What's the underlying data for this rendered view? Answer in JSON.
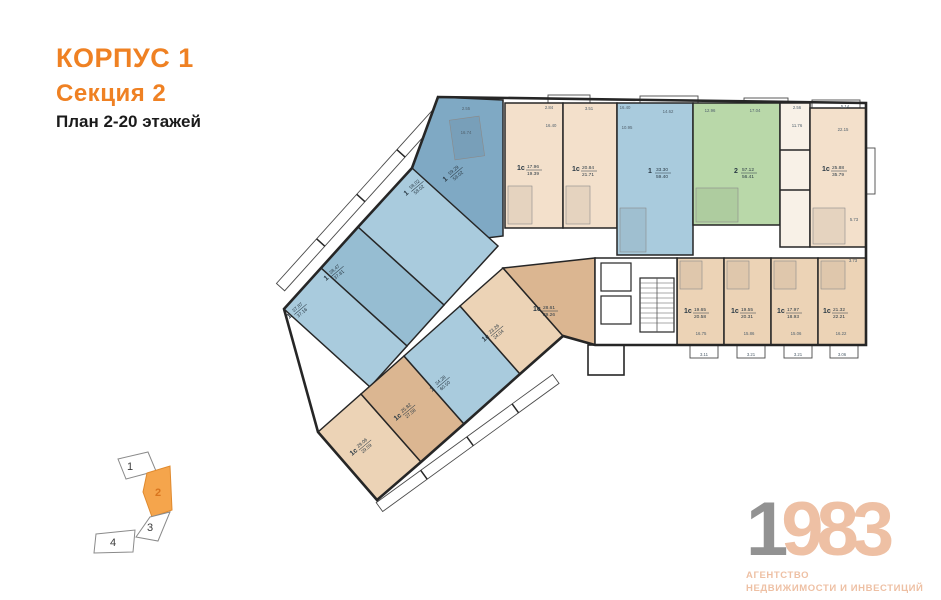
{
  "title": {
    "building": "КОРПУС 1",
    "section": "Секция 2",
    "floors": "План 2-20 этажей"
  },
  "colors": {
    "accent": "#ef8123",
    "wall": "#262626",
    "blue": "#a9cbdd",
    "blue_dark": "#7fa9c4",
    "blue_med": "#96bdd2",
    "green": "#b9d8a9",
    "beige_light": "#f3e0cb",
    "beige": "#ecd3b6",
    "beige_dark": "#dbb691",
    "utility": "#f8f1e7",
    "dim_text": "#51616d",
    "logo_gray": "#929292",
    "logo_peach": "#eec0a4",
    "minimap_orange": "#f5a54c"
  },
  "units": [
    {
      "id": "u1",
      "type": "1с",
      "a1": "17.96",
      "a2": "19.39"
    },
    {
      "id": "u2",
      "type": "1с",
      "a1": "20.84",
      "a2": "21.71"
    },
    {
      "id": "u3",
      "type": "1",
      "a1": "33.30",
      "a2": "59.40"
    },
    {
      "id": "u4",
      "type": "2",
      "a1": "57.12",
      "a2": "56.41"
    },
    {
      "id": "u5",
      "type": "1с",
      "a1": "25.88",
      "a2": "35.79"
    },
    {
      "id": "u6",
      "type": "1с",
      "a1": "19.65",
      "a2": "20.58"
    },
    {
      "id": "u7",
      "type": "1с",
      "a1": "19.55",
      "a2": "20.31"
    },
    {
      "id": "u8",
      "type": "1с",
      "a1": "17.97",
      "a2": "18.93"
    },
    {
      "id": "u9",
      "type": "1с",
      "a1": "21.32",
      "a2": "22.21"
    },
    {
      "id": "b1",
      "type": "1",
      "a1": "59.29",
      "a2": "59.02"
    },
    {
      "id": "b2",
      "type": "1",
      "a1": "58.02",
      "a2": "58.02"
    },
    {
      "id": "b3",
      "type": "1",
      "a1": "38.47",
      "a2": "37.81"
    },
    {
      "id": "b4",
      "type": "1",
      "a1": "37.87",
      "a2": "37.16"
    },
    {
      "id": "c4",
      "type": "1с",
      "a1": "29.06",
      "a2": "29.59"
    },
    {
      "id": "c3",
      "type": "1с",
      "a1": "25.82",
      "a2": "27.58"
    },
    {
      "id": "c5",
      "type": "1",
      "a1": "34.28",
      "a2": "60.50"
    },
    {
      "id": "c1",
      "type": "1с",
      "a1": "23.26",
      "a2": "24.04"
    },
    {
      "id": "c2",
      "type": "1с",
      "a1": "28.61",
      "a2": "29.26"
    }
  ],
  "dims": [
    "2.55",
    "2.84",
    "3.51",
    "16.40",
    "14.62",
    "12.96",
    "17.04",
    "2.56",
    "5.14",
    "16.74",
    "16.40",
    "10.95",
    "11.76",
    "22.15",
    "5.73",
    "3.73",
    "16.75",
    "15.86",
    "15.06",
    "16.22",
    "3.11",
    "3.21",
    "3.21",
    "3.06"
  ],
  "minimap": {
    "sections": [
      "1",
      "2",
      "3",
      "4"
    ],
    "active": "2"
  },
  "logo": {
    "year_1": "1",
    "year_rest": "983",
    "line1": "АГЕНТСТВО",
    "line2": "НЕДВИЖИМОСТИ И ИНВЕСТИЦИЙ"
  }
}
